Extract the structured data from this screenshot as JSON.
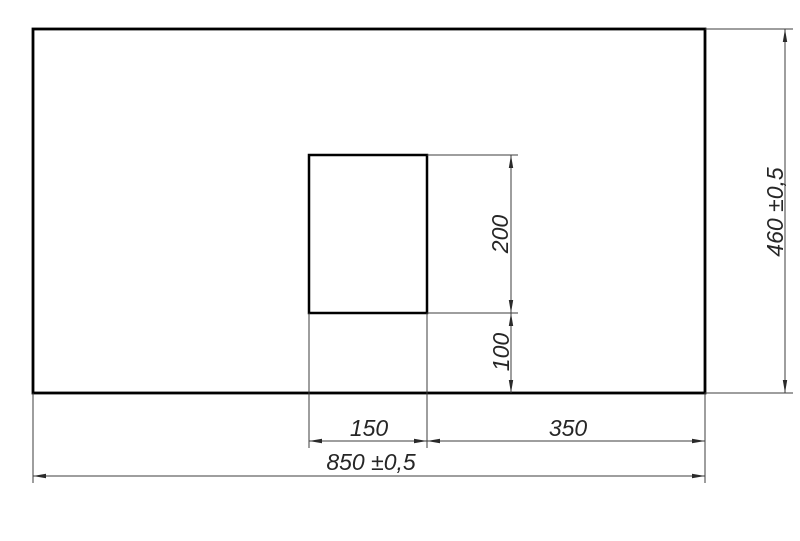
{
  "drawing": {
    "colors": {
      "background": "#ffffff",
      "outline": "#000000",
      "thin_line": "#3d3d3d",
      "text": "#262626"
    },
    "shapes": {
      "panel": "panel-outline",
      "cutout": "cutout-outline"
    },
    "dimensions": [
      {
        "id": "cutout-height",
        "orientation": "vertical",
        "value": "200"
      },
      {
        "id": "cutout-bottom-offset",
        "orientation": "vertical",
        "value": "100"
      },
      {
        "id": "cutout-width",
        "orientation": "horizontal",
        "value": "150"
      },
      {
        "id": "cutout-right-offset",
        "orientation": "horizontal",
        "value": "350"
      },
      {
        "id": "overall-width",
        "orientation": "horizontal",
        "value": "850 ±0,5"
      },
      {
        "id": "overall-height",
        "orientation": "vertical",
        "value": "460 ±0,5"
      }
    ]
  }
}
